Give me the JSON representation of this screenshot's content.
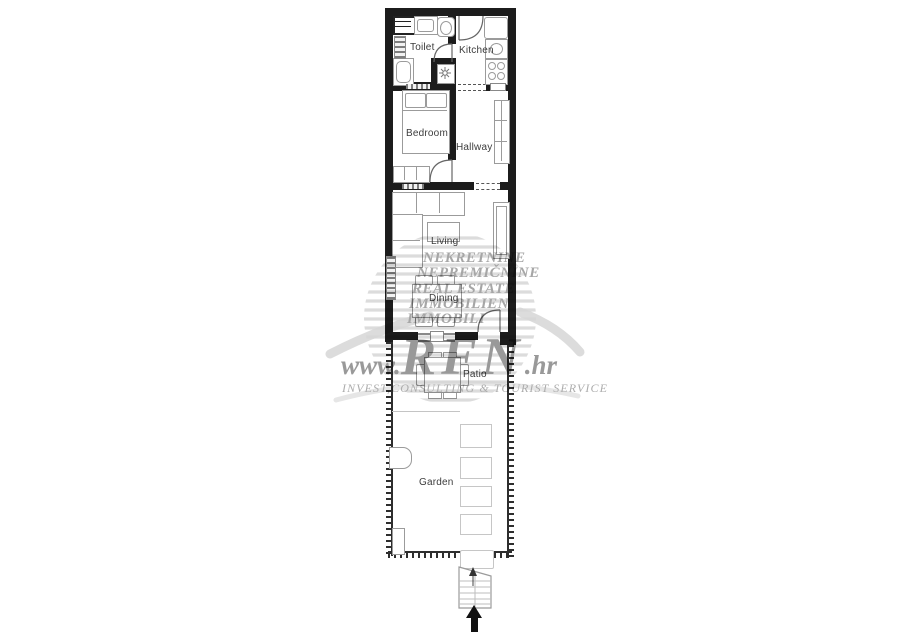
{
  "floorplan": {
    "rooms": {
      "toilet": "Toilet",
      "kitchen": "Kitchen",
      "bedroom": "Bedroom",
      "hallway": "Hallway",
      "living": "Living",
      "dining": "Dining",
      "patio": "Patio",
      "garden": "Garden"
    },
    "colors": {
      "wall": "#1c1c1c",
      "furniture_outline": "#9b9b9b",
      "label": "#3c3c3c"
    }
  },
  "watermark": {
    "languages": [
      "NEKRETNINE",
      "NEPREMIČNINE",
      "REAL ESTATE",
      "IMMOBILIEN",
      "IMMOBILI"
    ],
    "url": {
      "prefix": "www.",
      "name": "RFN",
      "suffix": ".hr"
    },
    "slogan": "INVEST,CONSULTING & TOURIST SERVICE",
    "text_color": "#a6a6a6",
    "globe_color": "#dcdcdc"
  }
}
